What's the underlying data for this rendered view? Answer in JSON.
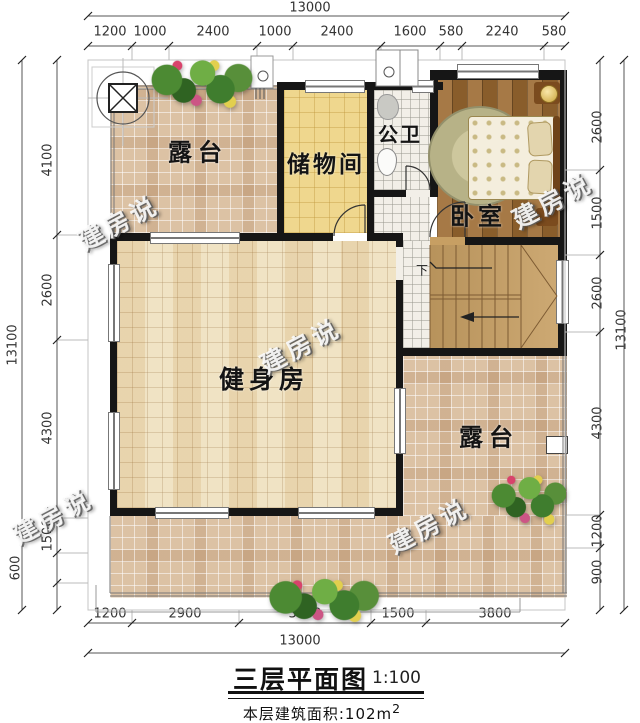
{
  "title": {
    "main": "三层平面图",
    "scale": "1:100",
    "area_label": "本层建筑面积:102m",
    "area_sup": "2"
  },
  "watermark": "建房说",
  "rooms": {
    "terrace_tl": "露台",
    "storage": "储物间",
    "bath": "公卫",
    "bedroom": "卧室",
    "gym": "健身房",
    "terrace_br": "露台",
    "stair_down": "下"
  },
  "dims": {
    "top_total": "13000",
    "top": [
      "1200",
      "1000",
      "2400",
      "1000",
      "2400",
      "1600",
      "580",
      "2240",
      "580"
    ],
    "bottom": [
      "1200",
      "2900",
      "3600",
      "1500",
      "3800"
    ],
    "bottom_total": "13000",
    "left": [
      "4100",
      "2600",
      "4300",
      "1500",
      "600"
    ],
    "left_total": "13100",
    "right": [
      "2600",
      "1500",
      "2600",
      "4300",
      "1200",
      "900"
    ],
    "right_total": "13100"
  },
  "colors": {
    "wall": "#161616",
    "terrace_tile": "#dcc2a4",
    "gym_floor": "#eedfbc",
    "storage_floor": "#efd78e",
    "bath_floor": "#f2efe8",
    "bedroom_wood": "#9c6a31",
    "stair_wood": "#c79f63",
    "dim_text": "#333333"
  }
}
